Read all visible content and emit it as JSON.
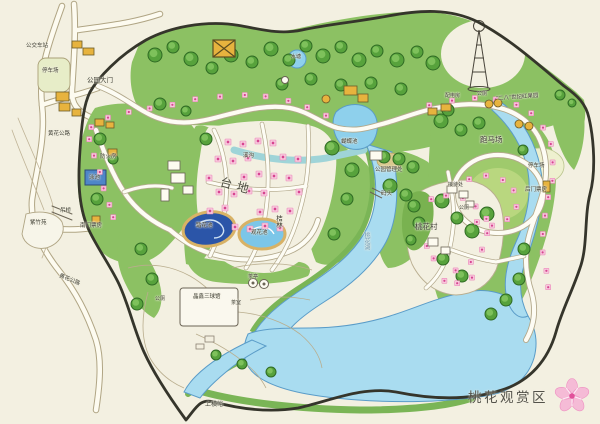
{
  "map": {
    "title": "桃花观赏区",
    "title_icon": "peach-blossom-icon",
    "colors": {
      "cream": "#f3f0e1",
      "green": "#8cc163",
      "green_dark": "#57a23c",
      "water": "#a9dcf0",
      "pond_dark": "#2b55a8",
      "blossom": "#f8c9dd",
      "blossom_dot": "#d64590",
      "building": "#e7b33e",
      "boundary": "#35352b",
      "title_color": "#53524a"
    },
    "labels": [
      {
        "name": "bus-station",
        "text": "公交车站",
        "x": 26,
        "y": 44,
        "fs": 5.5
      },
      {
        "name": "parking-nw",
        "text": "停车场",
        "x": 42,
        "y": 69,
        "fs": 5.5
      },
      {
        "name": "main-gate",
        "text": "公园大门",
        "x": 87,
        "y": 78,
        "fs": 6.5
      },
      {
        "name": "road-nw",
        "text": "黄花公路",
        "x": 48,
        "y": 132,
        "fs": 5.5
      },
      {
        "name": "fire-house",
        "text": "防火房",
        "x": 100,
        "y": 155,
        "fs": 5.5
      },
      {
        "name": "swim-pool",
        "text": "泳池",
        "x": 89,
        "y": 176,
        "fs": 5.5
      },
      {
        "name": "suspension-bridge",
        "text": "吊桥",
        "x": 60,
        "y": 209,
        "fs": 5.5
      },
      {
        "name": "south-ticket-office",
        "text": "南门票房",
        "x": 80,
        "y": 224,
        "fs": 5.5
      },
      {
        "name": "zizhu-garden",
        "text": "紫竹苑",
        "x": 30,
        "y": 221,
        "fs": 5.5
      },
      {
        "name": "road-sw",
        "text": "黄花公路",
        "x": 60,
        "y": 274,
        "fs": 5.5,
        "rotate": 22
      },
      {
        "name": "terrace",
        "text": "台地",
        "x": 222,
        "y": 176,
        "fs": 12,
        "ls": 5,
        "rotate": 15,
        "color": "#4a4a3e"
      },
      {
        "name": "orchard-grove",
        "text": "桔林",
        "x": 274,
        "y": 215,
        "fs": 6.5,
        "vertical": true
      },
      {
        "name": "pond-left",
        "text": "踏花池",
        "x": 196,
        "y": 224,
        "fs": 5.5
      },
      {
        "name": "pond-right",
        "text": "观花池",
        "x": 251,
        "y": 231,
        "fs": 5.5
      },
      {
        "name": "butterfly-pond",
        "text": "蝴蝶池",
        "x": 341,
        "y": 140,
        "fs": 5.5
      },
      {
        "name": "small-pond",
        "text": "水塘",
        "x": 291,
        "y": 55,
        "fs": 5
      },
      {
        "name": "stream",
        "text": "溪沟",
        "x": 243,
        "y": 154,
        "fs": 5.5
      },
      {
        "name": "park-management",
        "text": "公园管理处",
        "x": 375,
        "y": 168,
        "fs": 5.5
      },
      {
        "name": "dock",
        "text": "码头",
        "x": 381,
        "y": 192,
        "fs": 5.5
      },
      {
        "name": "peach-village",
        "text": "桃花村",
        "x": 415,
        "y": 223,
        "fs": 7.5
      },
      {
        "name": "reception",
        "text": "接待处",
        "x": 448,
        "y": 183,
        "fs": 5
      },
      {
        "name": "toilet-village",
        "text": "公厕",
        "x": 459,
        "y": 206,
        "fs": 5
      },
      {
        "name": "racecourse",
        "text": "跑马场",
        "x": 480,
        "y": 136,
        "fs": 7.5
      },
      {
        "name": "parking-ne",
        "text": "停车场",
        "x": 528,
        "y": 164,
        "fs": 5.5
      },
      {
        "name": "rear-ticket-office",
        "text": "后门票房",
        "x": 525,
        "y": 188,
        "fs": 5.5
      },
      {
        "name": "century-red-orchard",
        "text": "\"二八\"世纪红果园",
        "x": 496,
        "y": 97,
        "fs": 5.5,
        "rotate": -4
      },
      {
        "name": "power-house",
        "text": "配电房",
        "x": 445,
        "y": 94,
        "fs": 5
      },
      {
        "name": "toilet-north",
        "text": "公厕",
        "x": 477,
        "y": 92,
        "fs": 5
      },
      {
        "name": "ball-hall",
        "text": "晶鑫三球馆",
        "x": 193,
        "y": 295,
        "fs": 5.5
      },
      {
        "name": "toilet-west",
        "text": "公厕",
        "x": 155,
        "y": 297,
        "fs": 5
      },
      {
        "name": "tea-room",
        "text": "茶室",
        "x": 231,
        "y": 301,
        "fs": 5
      },
      {
        "name": "tea-pavilion",
        "text": "茶亭",
        "x": 248,
        "y": 275,
        "fs": 5
      },
      {
        "name": "shangheng-valley",
        "text": "上横峪",
        "x": 205,
        "y": 402,
        "fs": 6
      },
      {
        "name": "peach-lake",
        "text": "桃花湖",
        "x": 363,
        "y": 232,
        "fs": 6,
        "vertical": true,
        "color": "#6f9cb8"
      }
    ]
  }
}
